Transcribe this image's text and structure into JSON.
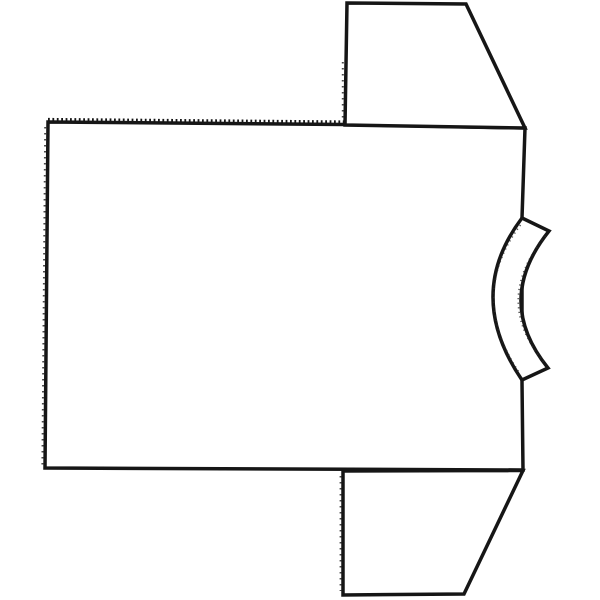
{
  "canvas": {
    "width": 600,
    "height": 600,
    "background_color": "#ffffff",
    "ink_color": "#161616",
    "line_width": 3.5
  },
  "figure": {
    "name": "t-shirt-pattern-outline",
    "shapes": {
      "body": {
        "d": "M 48,122 L 345,124.5 L 525,128 L 522,218 L 522,382 L 523,470 L 45,468 Z"
      },
      "top_sleeve": {
        "d": "M 347,3 L 466,4 L 525,128 L 345,125 Z"
      },
      "bottom_sleeve": {
        "d": "M 343,471 L 523,470.5 L 464,594 L 343,595 Z"
      },
      "collar": {
        "d": "M 522,218 L 549,231 Q 493.5,300.5 548,368 L 522,380 Q 464,295 522,218 Z"
      },
      "serration_body_top": {
        "d": "M 48,119.4 L 345,121.9"
      },
      "serration_body_left": {
        "d": "M 45.2,127 L 42.4,465"
      },
      "serration_top_sleeve_left": {
        "d": "M 342.8,62 L 342.8,121"
      },
      "serration_bottom_sleeve_left": {
        "d": "M 340.6,476 L 340.6,591"
      },
      "collar_outer_fuzz": {
        "d": "M 520.5,225 Q 467.5,295.5 519.5,373"
      },
      "collar_inner_fuzz": {
        "d": "M 545.5,236 Q 491.5,300.5 544.5,363"
      }
    }
  }
}
